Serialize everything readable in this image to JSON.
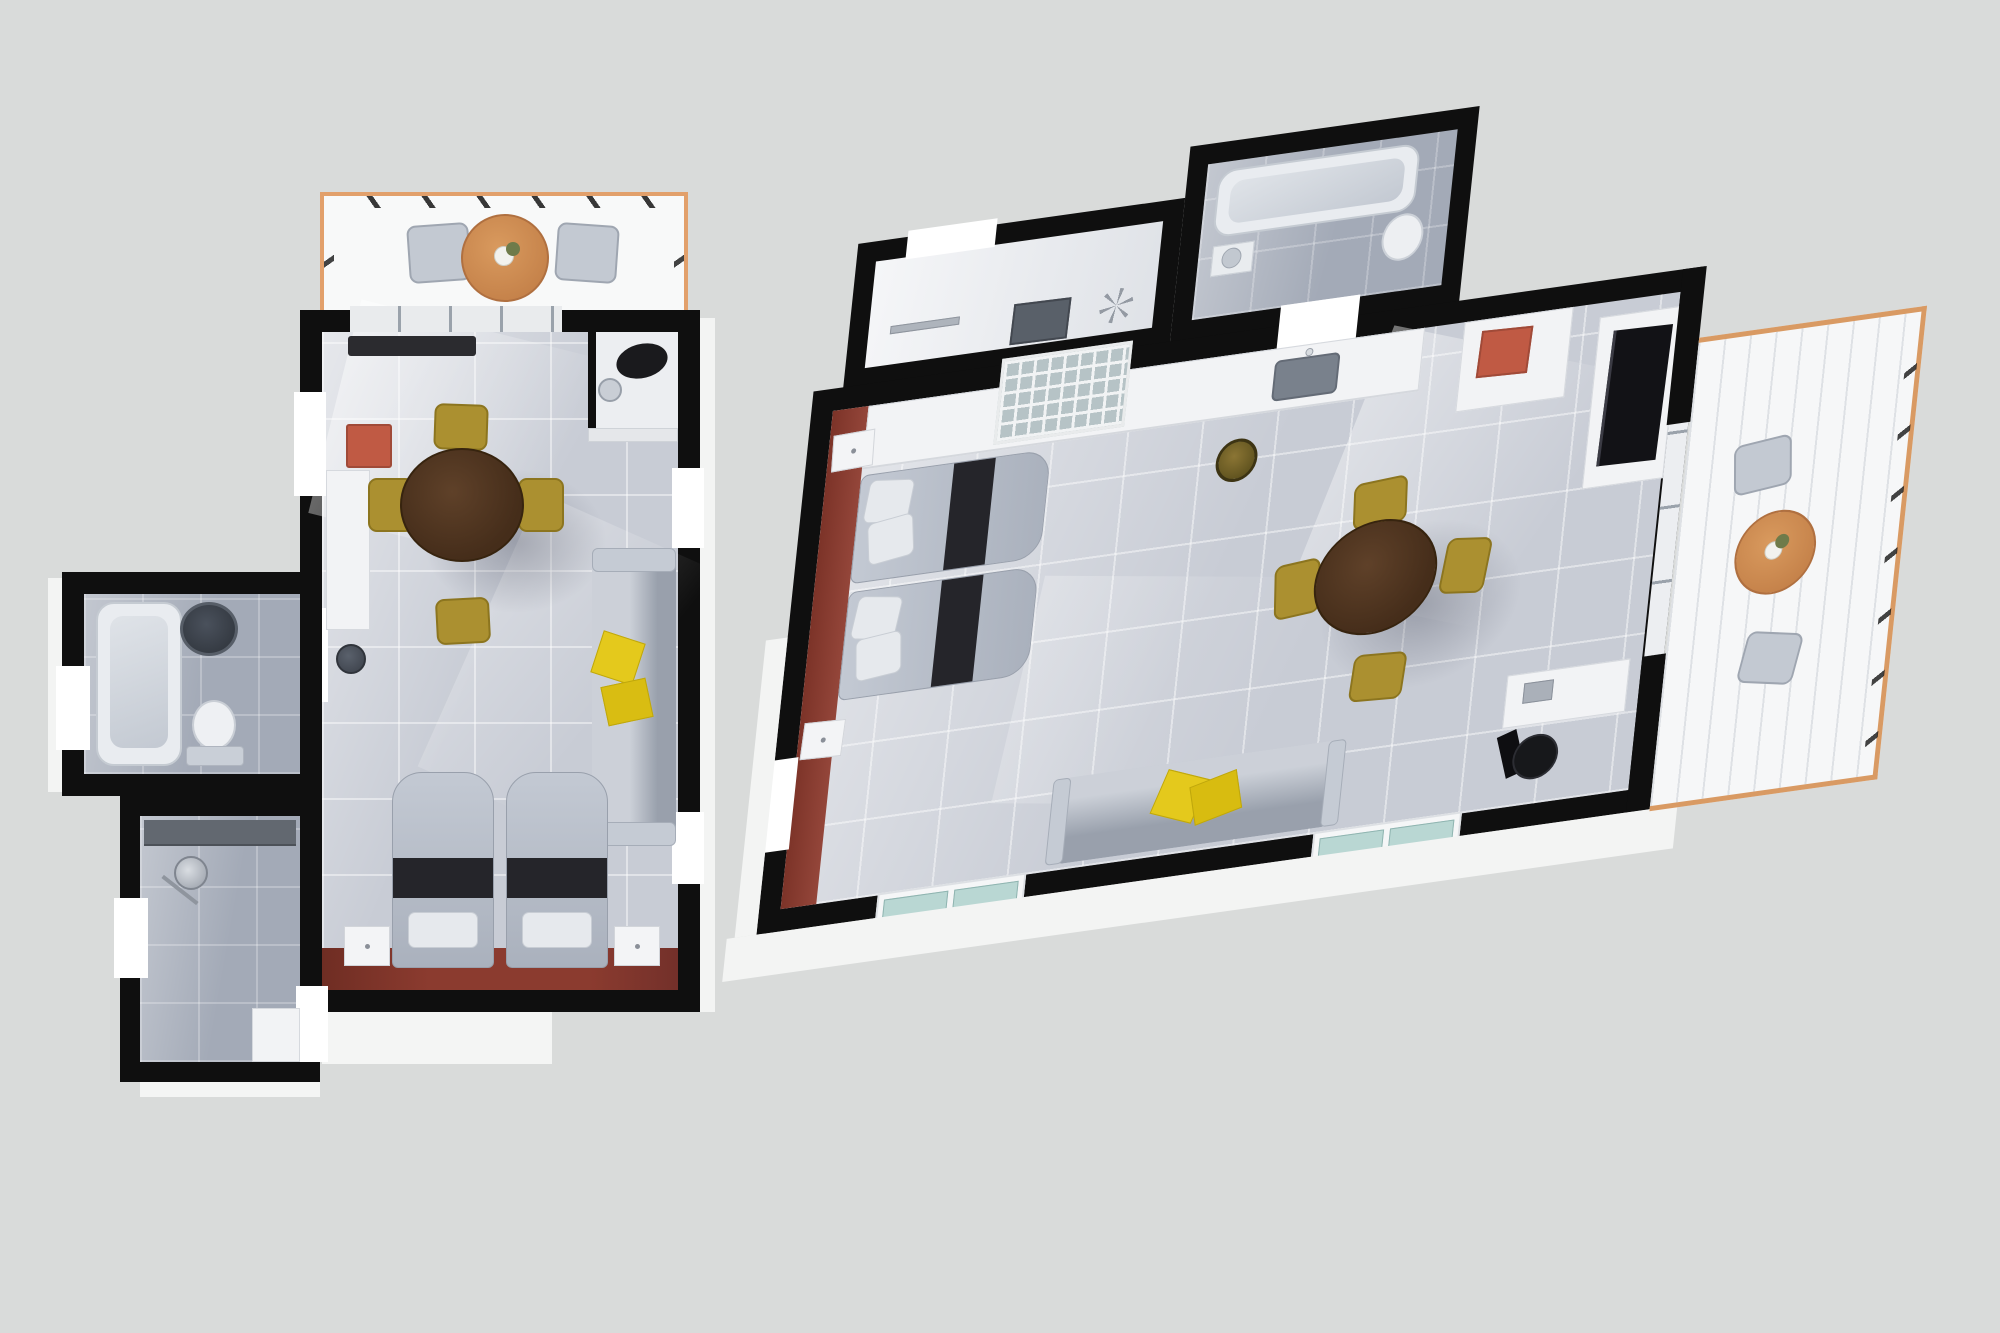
{
  "scene": {
    "type": "3d-floor-plan-rendering",
    "view": "top-down dollhouse view",
    "background_color": "#d9dbda",
    "plan_count": 2
  },
  "palette": {
    "wall_black": "#0f0f0f",
    "floor_tile": "#c8ccd5",
    "floor_tile_dark": "#a3aab7",
    "balcony_rail_orange": "#e2a06b",
    "balcony_table_orange": "#cd8a4f",
    "dining_table_brown": "#533722",
    "chair_mustard": "#ab9030",
    "cushion_yellow": "#e4c91c",
    "bed_gray": "#b7bdc9",
    "blanket_black": "#25252a",
    "accent_maroon": "#8b3a2e",
    "red_cabinet": "#c05a44",
    "fixture_white": "#f3f4f6",
    "window_glass_teal": "#b9d7d3"
  },
  "plans": {
    "left": {
      "label": "Floor plan A - portrait studio apartment",
      "rooms": [
        {
          "name": "balcony",
          "furniture": [
            "round bistro table with plant",
            "2 patio chairs"
          ]
        },
        {
          "name": "studio living room",
          "furniture": [
            "wall shelf",
            "red cabinet",
            "tall white cabinet",
            "wash basin",
            "round dining table",
            "4 mustard chairs",
            "sofa with 2 yellow cushions",
            "2 single beds with dark blankets",
            "2 nightstands",
            "dark red floor strip"
          ]
        },
        {
          "name": "wc niche",
          "furniture": [
            "toilet",
            "small basin"
          ]
        },
        {
          "name": "bathroom",
          "furniture": [
            "bathtub",
            "round dark basin",
            "toilet"
          ]
        },
        {
          "name": "shower room",
          "furniture": [
            "wall shelf",
            "shower fixture",
            "bench"
          ]
        }
      ]
    },
    "right": {
      "label": "Floor plan B - rotated studio apartment",
      "rooms": [
        {
          "name": "entry hall",
          "furniture": [
            "mirror panel",
            "coat rack"
          ]
        },
        {
          "name": "bathroom",
          "furniture": [
            "bathtub",
            "toilet",
            "basin"
          ]
        },
        {
          "name": "studio living room",
          "furniture": [
            "glass french door",
            "kitchen counter with sink",
            "trash bin",
            "tall cabinet with red box",
            "wall tv",
            "round dining table",
            "4 mustard chairs",
            "2 single beds with dark blankets",
            "2 nightstands",
            "sofa with 2 yellow cushions",
            "desk",
            "black office chair",
            "teal bottom windows",
            "maroon accent wall"
          ]
        },
        {
          "name": "balcony",
          "furniture": [
            "round bistro table with plant",
            "2 patio chairs"
          ]
        }
      ]
    }
  }
}
